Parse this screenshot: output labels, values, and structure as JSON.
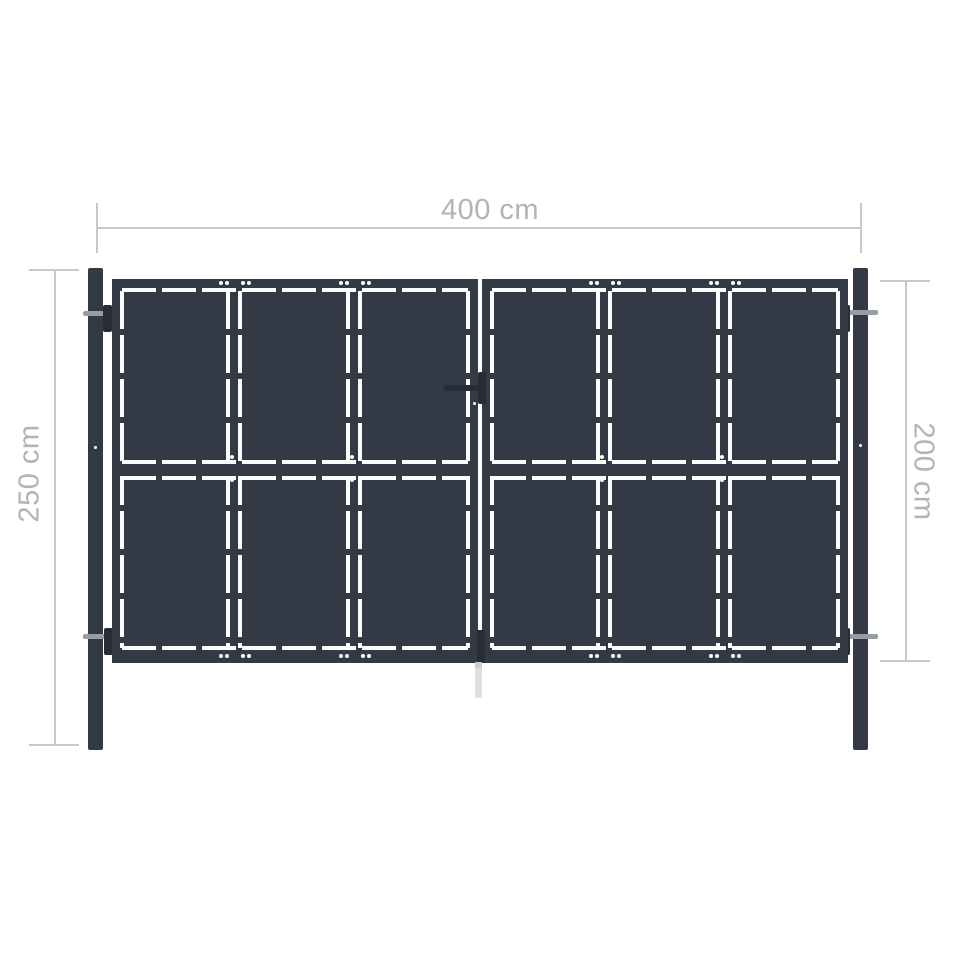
{
  "diagram": {
    "type": "product-dimension-diagram",
    "subject": "double garden gate in anthracite steel with two posts",
    "dimensions": {
      "width": {
        "value": "400 cm",
        "position": "top"
      },
      "post_height": {
        "value": "250 cm",
        "position": "left"
      },
      "gate_height": {
        "value": "200 cm",
        "position": "right"
      }
    },
    "structure": {
      "panels": 2,
      "columns_per_panel": 3,
      "rows_per_panel": 2,
      "features": [
        "handle and lock plate at center of gate",
        "drop rod below center bottom",
        "two hinges per post",
        "white gap lines outlining frame, dividers and middle rail"
      ]
    }
  },
  "colors": {
    "steel": "#333a45",
    "steel-dark": "#272d36",
    "gap-white": "#fcfcfd",
    "dim-line": "#c8c8c8",
    "dim-text": "#b3b3b3",
    "hinge-pin": "#979da5",
    "drop-rod": "#d6d6d6",
    "bg": "#ffffff"
  }
}
